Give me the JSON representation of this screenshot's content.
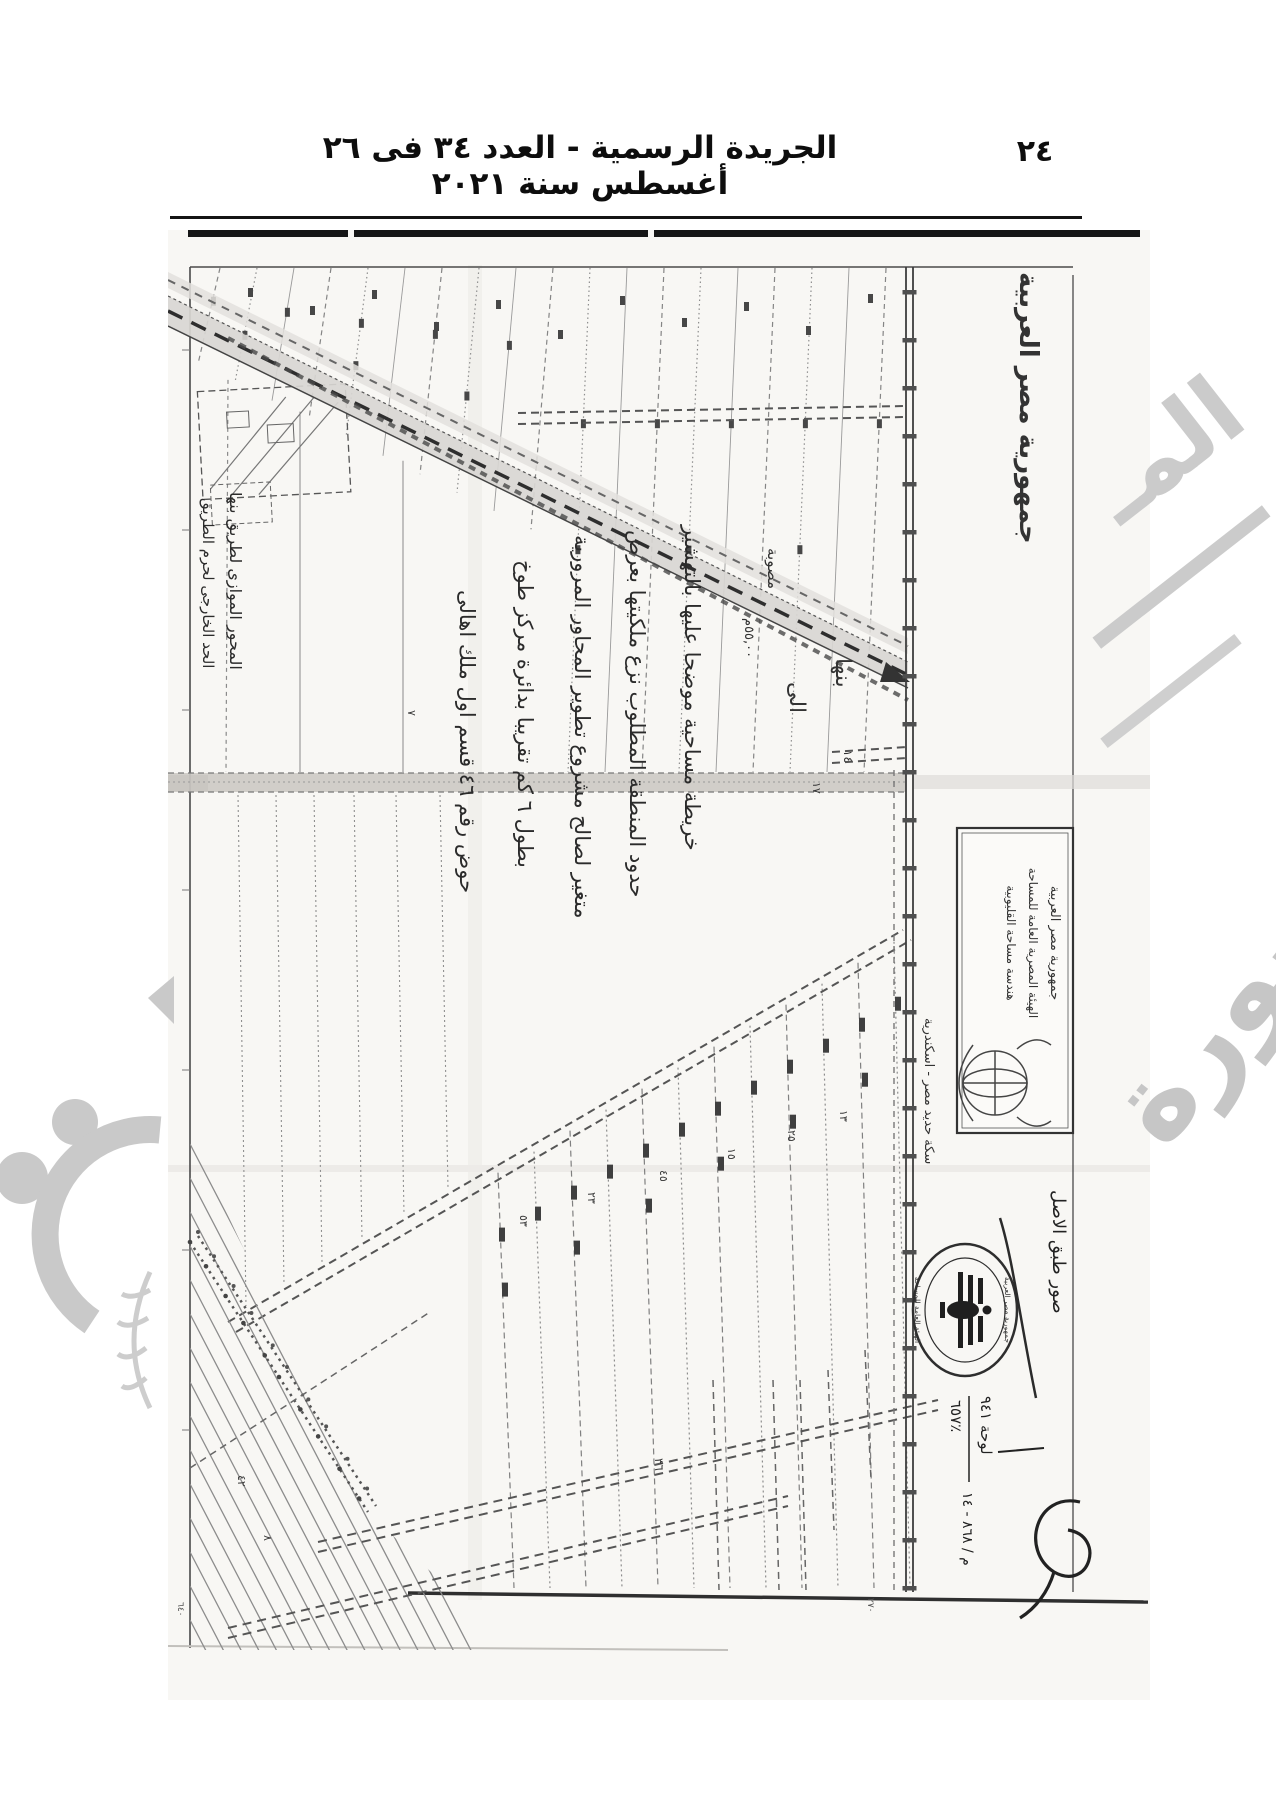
{
  "page": {
    "header_title": "الجريدة الرسمية - العدد ٣٤ فى ٢٦ أغسطس سنة ٢٠٢١",
    "page_number": "٢٤"
  },
  "map": {
    "country_label": "جمهورية مصر العربية",
    "labels": {
      "to_banha_1": "الى",
      "to_banha_2": "بنها",
      "road_width": "٥٥,٠٠م",
      "surveyed": "مصوبة",
      "railway": "سكة حديد مصر - اسكندرية",
      "km_14": "١٤",
      "km_17": "١٧"
    },
    "annotations": {
      "line1": "خريطة مساحية موضحا عليها بالتهشير",
      "line2": "حدود المنطقة المطلوب نزع ملكيتها بعرض",
      "line3": "متغير لصالح مشروع تطوير المحاور المرورية",
      "line4": "بطول ٦ كم تقريبا بدائرة مركز طوخ",
      "line5": "حوض رقم ٤٦ قسم اول ملك اهالى",
      "left_line1": "المحور الموازى لطريق بنها",
      "left_line2": "الحد الخارجى لحرم الطريق"
    },
    "parcel_numbers": [
      "٥٣",
      "٢٣",
      "٤٥",
      "١٥",
      "٢٥",
      "١٣",
      "٨",
      "٤٢",
      "٣٦",
      "٧"
    ],
    "corner_values": {
      "bottom_left": "٦٤٠",
      "bottom_right": "٢٧٠"
    },
    "stamps": {
      "rect": {
        "line1": "جمهورية مصر العربية",
        "line2": "الهيئة المصرية العامة للمساحة",
        "line3": "هندسة مساحة القليوبية"
      },
      "seal": {
        "top": "جمهورية مصر العربية",
        "bottom": "الهيئة العامة للمساحة"
      },
      "copy_note": "صور طبق الاصل",
      "sheet_ref": "لوحة ٩٤١",
      "scale_ref": "٦٥٧٪",
      "file_ref": "م / ٨٦٨ - ١٤"
    },
    "watermark": {
      "fragment": "المـ",
      "word": "صورة"
    }
  }
}
